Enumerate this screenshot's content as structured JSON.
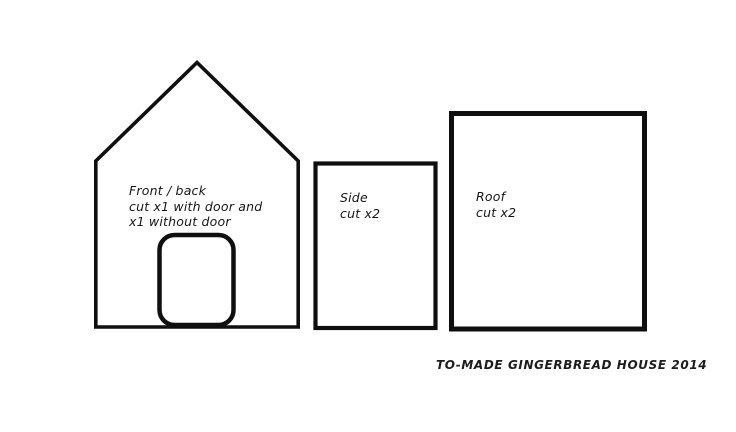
{
  "caption": "TO-MADE GINGERBREAD HOUSE 2014",
  "pieces": [
    {
      "id": "front-back",
      "label_lines": [
        "Front / back",
        "cut x1 with door and",
        "x1 without door"
      ]
    },
    {
      "id": "side",
      "label_lines": [
        "Side",
        "cut x2"
      ]
    },
    {
      "id": "roof",
      "label_lines": [
        "Roof",
        "cut x2"
      ]
    }
  ],
  "colors": {
    "line": "#0f0f0f",
    "background": "#ffffff",
    "text": "#161616"
  }
}
